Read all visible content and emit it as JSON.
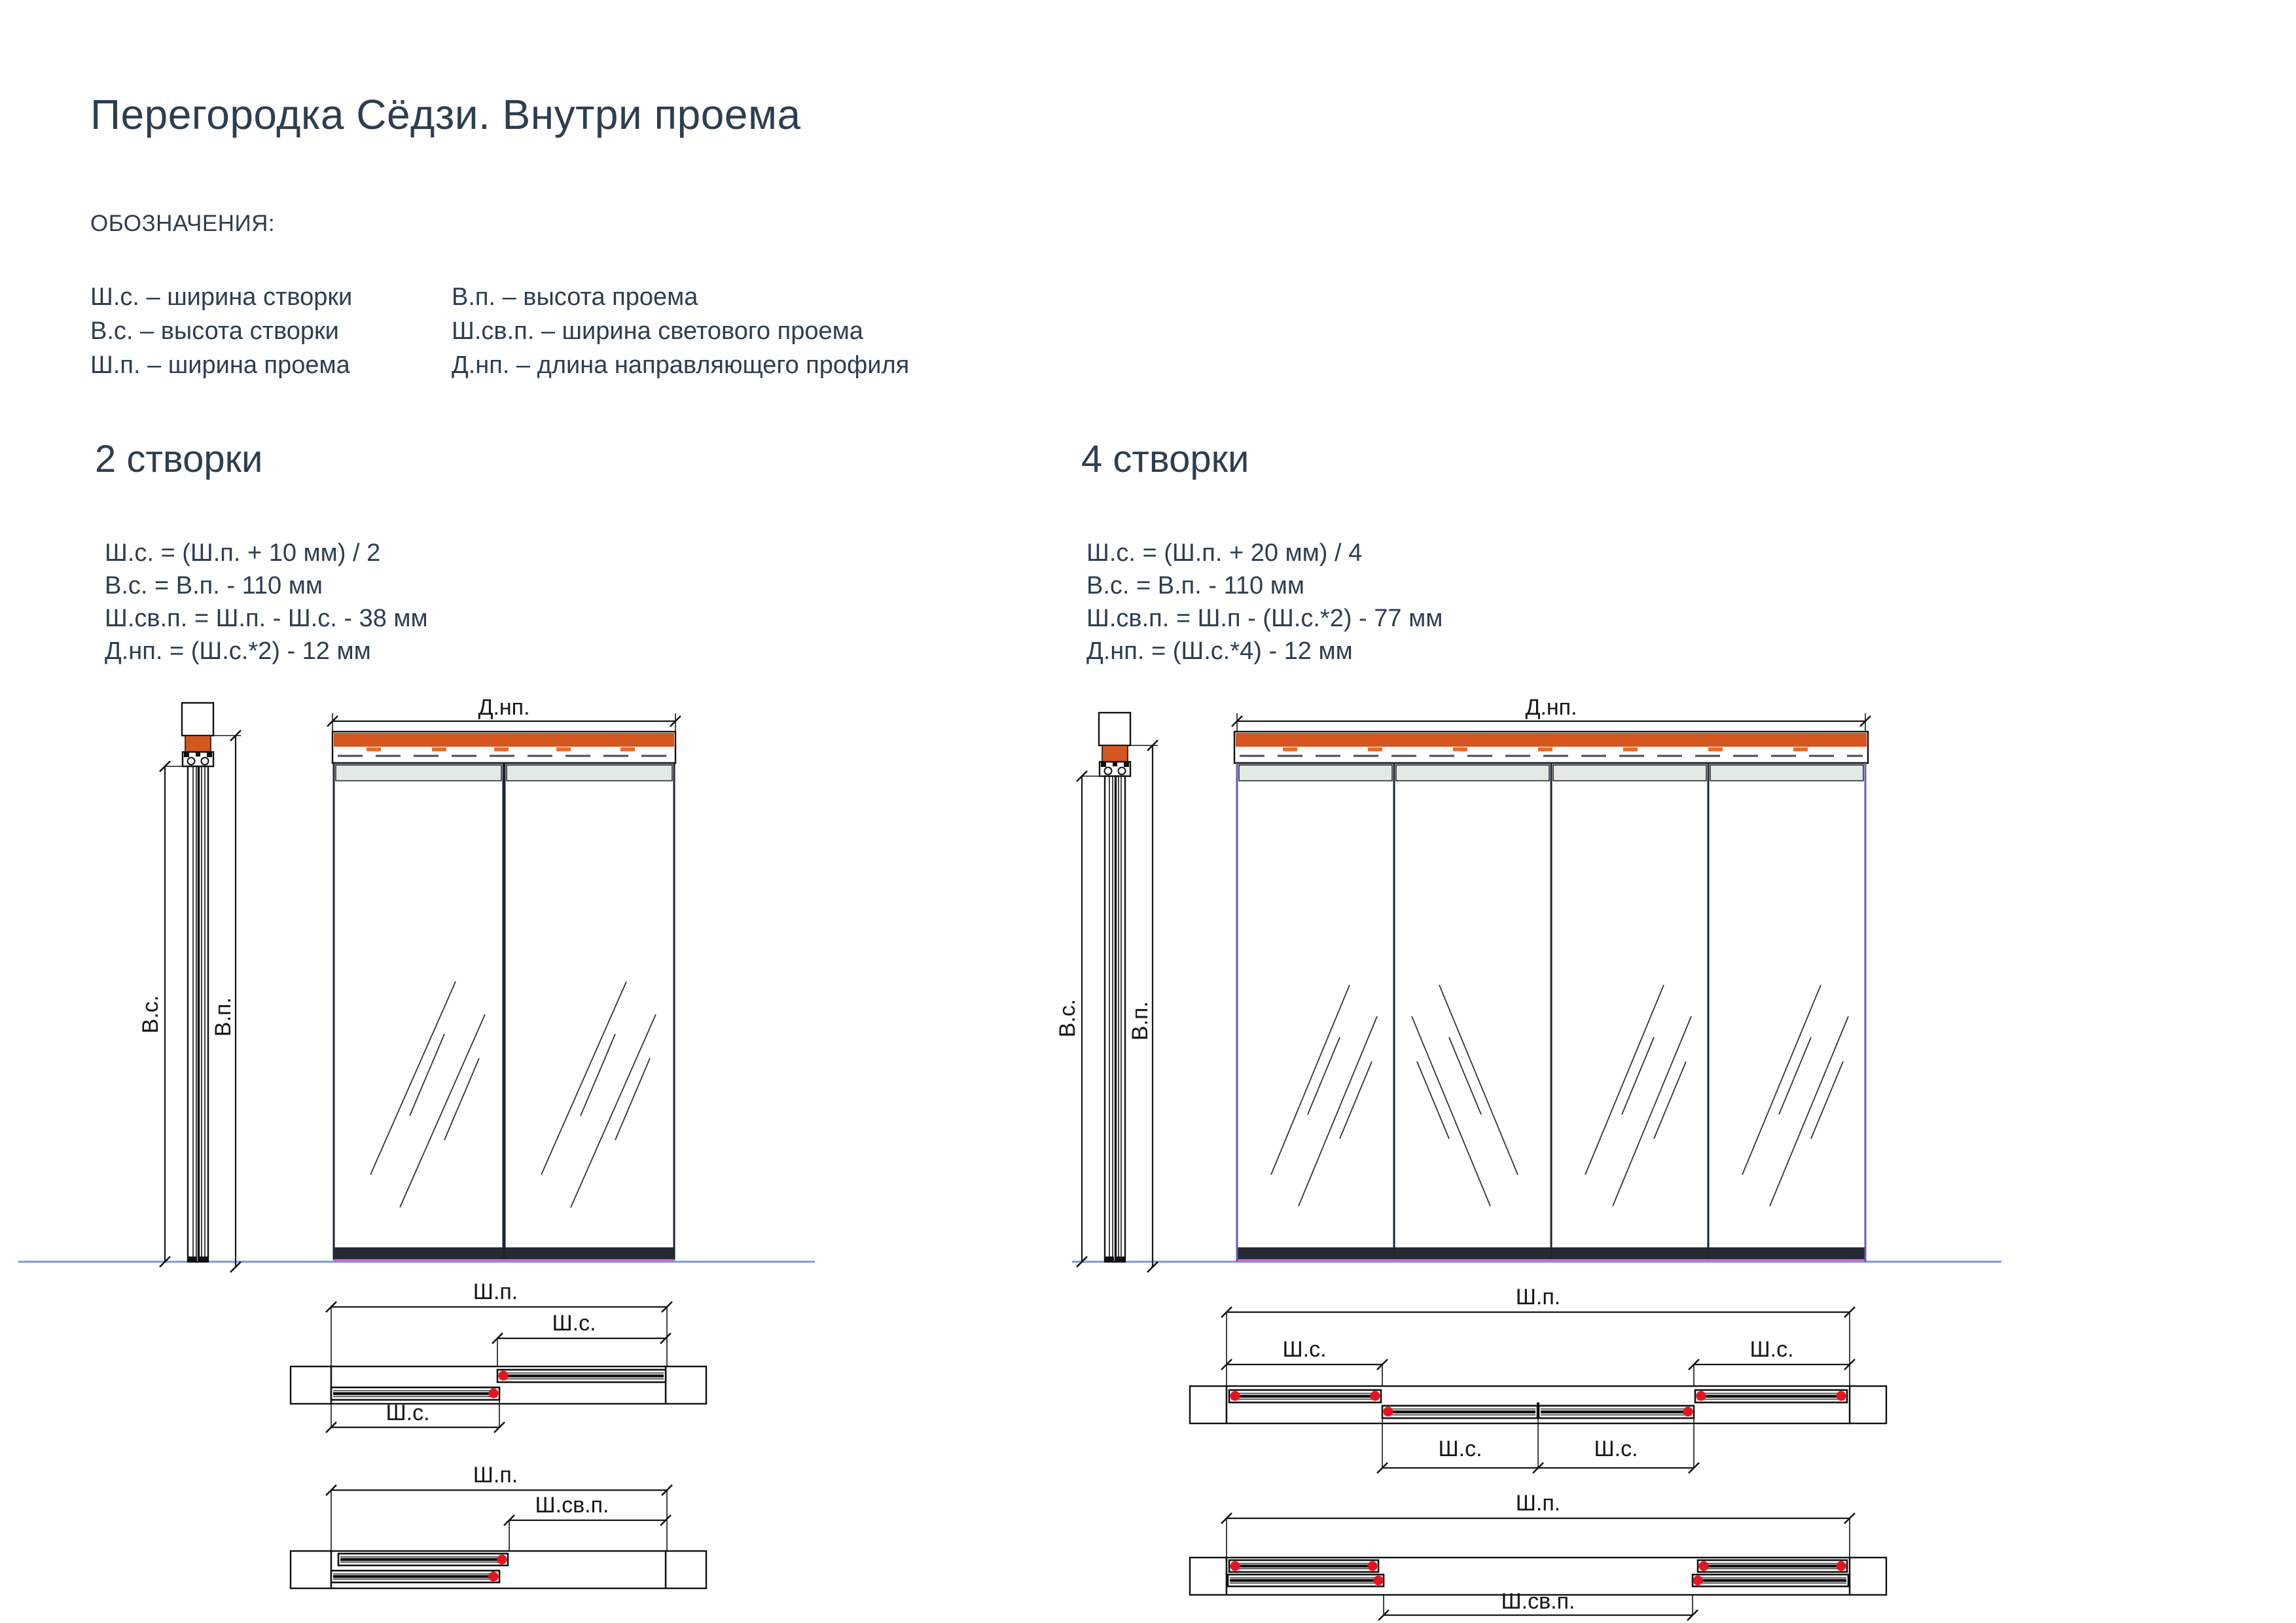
{
  "page": {
    "title": "Перегородка Сёдзи. Внутри проема",
    "legend_heading": "ОБОЗНАЧЕНИЯ:",
    "legend_col1": [
      "Ш.с. – ширина створки",
      "В.с. – высота створки",
      "Ш.п. – ширина проема"
    ],
    "legend_col2": [
      "В.п. – высота проема",
      "Ш.св.п. – ширина светового проема",
      "Д.нп. – длина направляющего профиля"
    ]
  },
  "variants": [
    {
      "heading": "2 створки",
      "formulas": [
        "Ш.с. = (Ш.п. + 10 мм) / 2",
        "В.с. = В.п. - 110 мм",
        "Ш.св.п. = Ш.п. - Ш.с. - 38 мм",
        "Д.нп. = (Ш.с.*2) - 12 мм"
      ]
    },
    {
      "heading": "4 створки",
      "formulas": [
        "Ш.с. = (Ш.п. + 20 мм) / 4",
        "В.с. = В.п. - 110 мм",
        "Ш.св.п. = Ш.п - (Ш.с.*2) - 77 мм",
        "Д.нп. = (Ш.с.*4) - 12 мм"
      ]
    }
  ],
  "dim_labels": {
    "dnp": "Д.нп.",
    "vs": "В.с.",
    "vp": "В.п.",
    "shp": "Ш.п.",
    "shs": "Ш.с.",
    "shsvp": "Ш.св.п."
  },
  "colors": {
    "text": "#2d3e50",
    "track_orange": "#d4571f",
    "orange_dash": "#e96b2d",
    "rail_gray": "#e3eae6",
    "bottom_rail": "#262b33",
    "purple_strip": "#c06fd8",
    "violet_edge": "#6b57b8",
    "floor_blue": "#7a97d8",
    "handle_red": "#e8131f"
  }
}
